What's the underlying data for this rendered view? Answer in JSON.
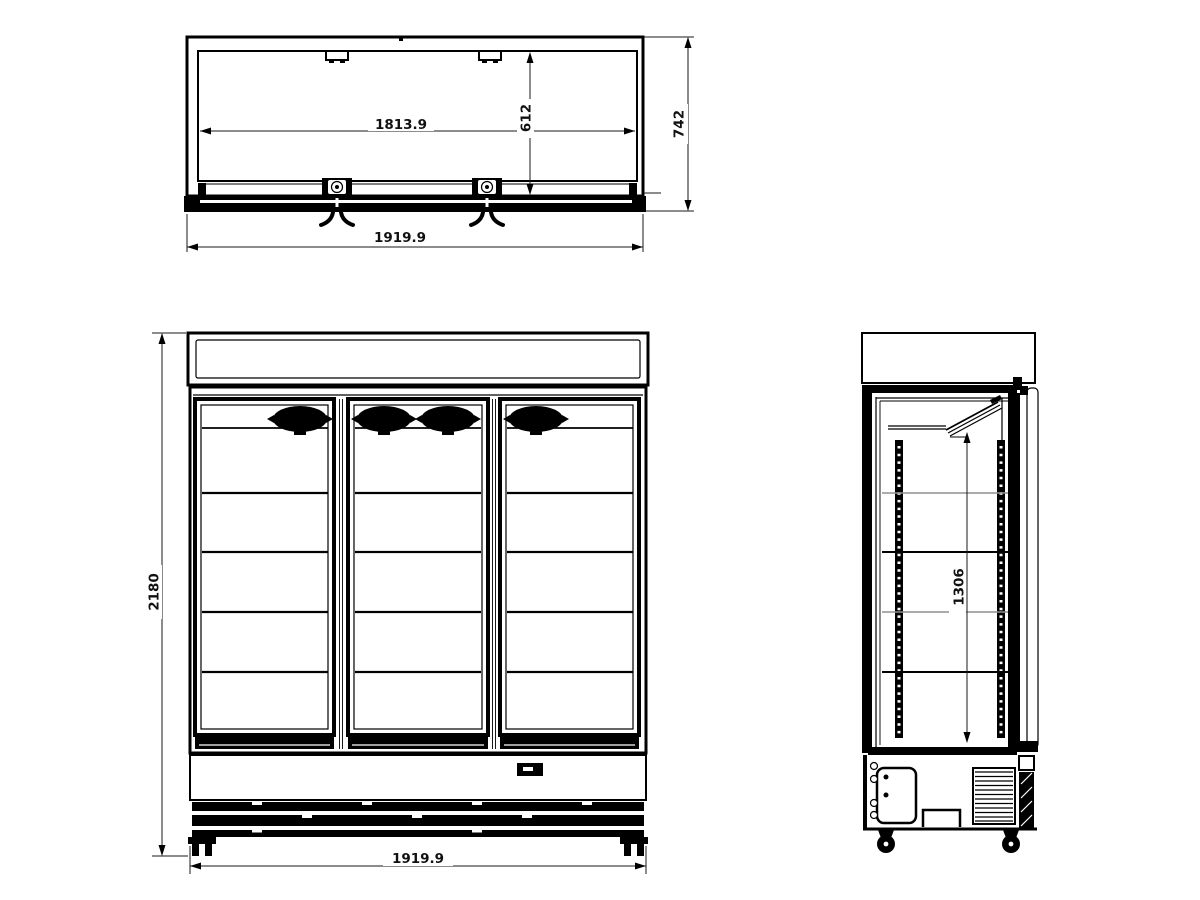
{
  "colors": {
    "background": "#ffffff",
    "line": "#000000",
    "shelf-line": "#8f8f8f"
  },
  "dimensions": {
    "top_inner_width": "1813.9",
    "top_inner_depth": "612",
    "top_overall_depth": "742",
    "top_overall_width": "1919.9",
    "front_overall_width": "1919.9",
    "front_overall_height": "2180",
    "side_interior_height": "1306"
  }
}
